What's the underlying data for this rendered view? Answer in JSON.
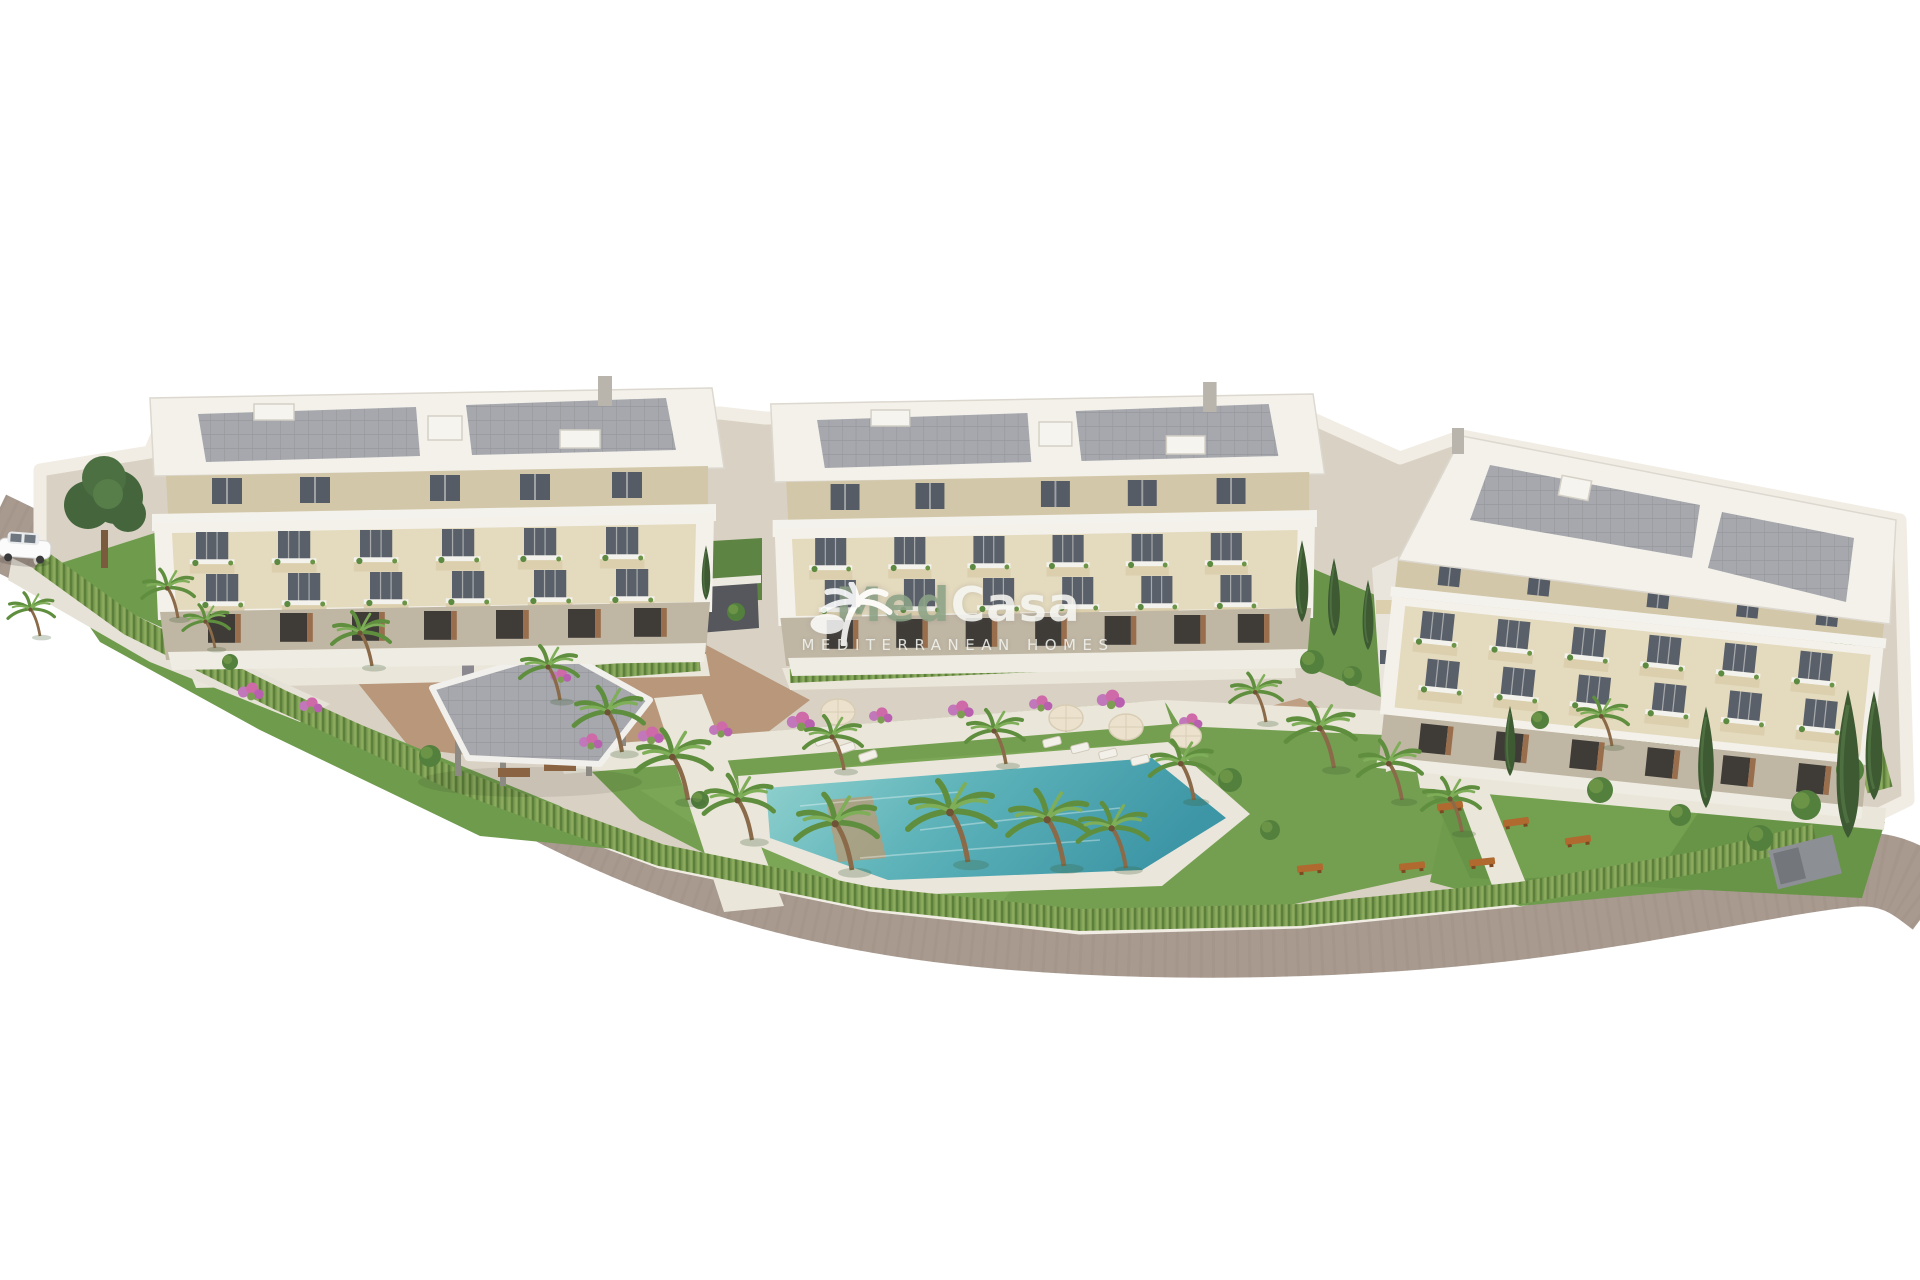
{
  "page": {
    "background": "#ffffff",
    "description": "Aerial 3D architectural rendering of a new-build Mediterranean residential complex: three modern white apartment blocks with cream facades and balconies, communal landscaped gardens with palm trees, a free-form swimming pool, a pergola pavilion, perimeter hedge and a curving road around the plot"
  },
  "watermark": {
    "brand_part1": "Med",
    "brand_part2": "Casa",
    "tagline": "MEDITERRANEAN HOMES",
    "icon": "palm-tree-icon",
    "brand_green": "#8ca386",
    "brand_white": "#f6f6f2"
  },
  "scene": {
    "buildings": {
      "count": 3,
      "levels_visible": 4
    },
    "objects": [
      "left-apartment-building",
      "center-apartment-building",
      "right-apartment-building",
      "swimming-pool",
      "pool-deck",
      "pergola-pavilion",
      "garage-ramp",
      "driveway",
      "perimeter-hedge",
      "boundary-wall",
      "asphalt-road",
      "white-car",
      "palm-trees",
      "cypress-trees",
      "deciduous-tree",
      "lawns",
      "flower-beds",
      "sun-loungers",
      "parasols",
      "garden-benches",
      "balcony-furniture"
    ],
    "palette": {
      "road": "#a89a8f",
      "curb_wall": "#f1ede4",
      "pavement": "#d9d2c4",
      "walkway": "#eae6da",
      "terracotta_paving": "#b8977b",
      "lawn": "#6f9b4d",
      "lawn_light": "#7fae59",
      "hedge": "#7d9e52",
      "pool_light": "#93d2cf",
      "pool_deep": "#3d96a6",
      "building_white": "#f3f1ea",
      "building_cream": "#e4dabe",
      "attic_beige": "#d3c7a9",
      "window_glass": "#59606a",
      "roof_panels": "#a6a8ad",
      "wood_accent": "#996e4d",
      "cypress_green": "#3d5a33",
      "palm_green": "#5f8f3e",
      "shrub_green": "#54803e",
      "flower_pink": "#c178bb",
      "bench_orange": "#b06a30",
      "pergola_roof": "#a3a0a8"
    }
  }
}
